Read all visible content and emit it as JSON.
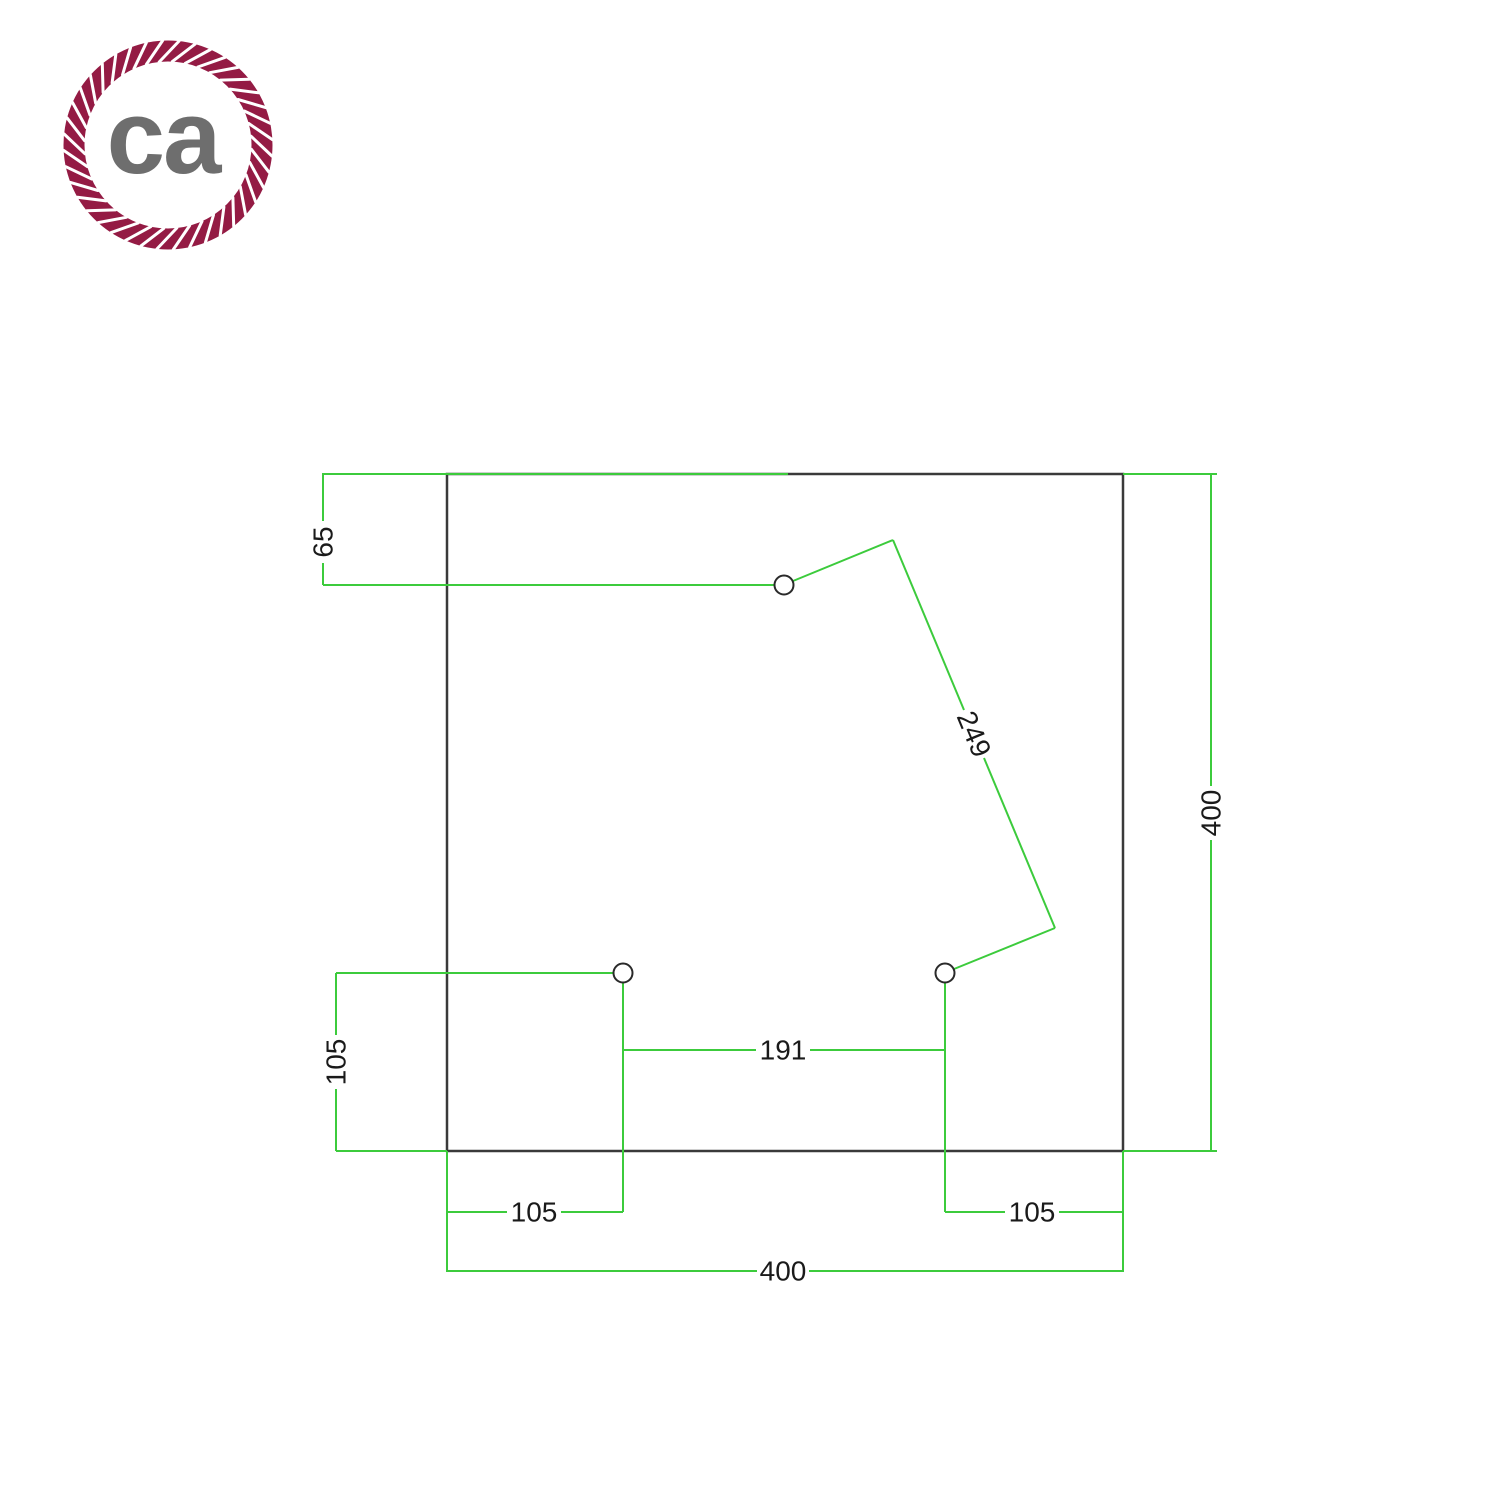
{
  "logo": {
    "text": "ca",
    "rope_color": "#941b44",
    "text_color": "#6e6e6e"
  },
  "drawing": {
    "colors": {
      "dimension_line": "#3ccb3c",
      "outline": "#3a3a3a",
      "label_text": "#1a1a1a"
    },
    "dimensions": {
      "top_hole_offset": "65",
      "plate_height": "400",
      "plate_width": "400",
      "left_hole_height": "105",
      "left_hole_inset": "105",
      "right_hole_inset": "105",
      "bottom_holes_spacing": "191",
      "diagonal_holes_spacing": "249"
    }
  }
}
